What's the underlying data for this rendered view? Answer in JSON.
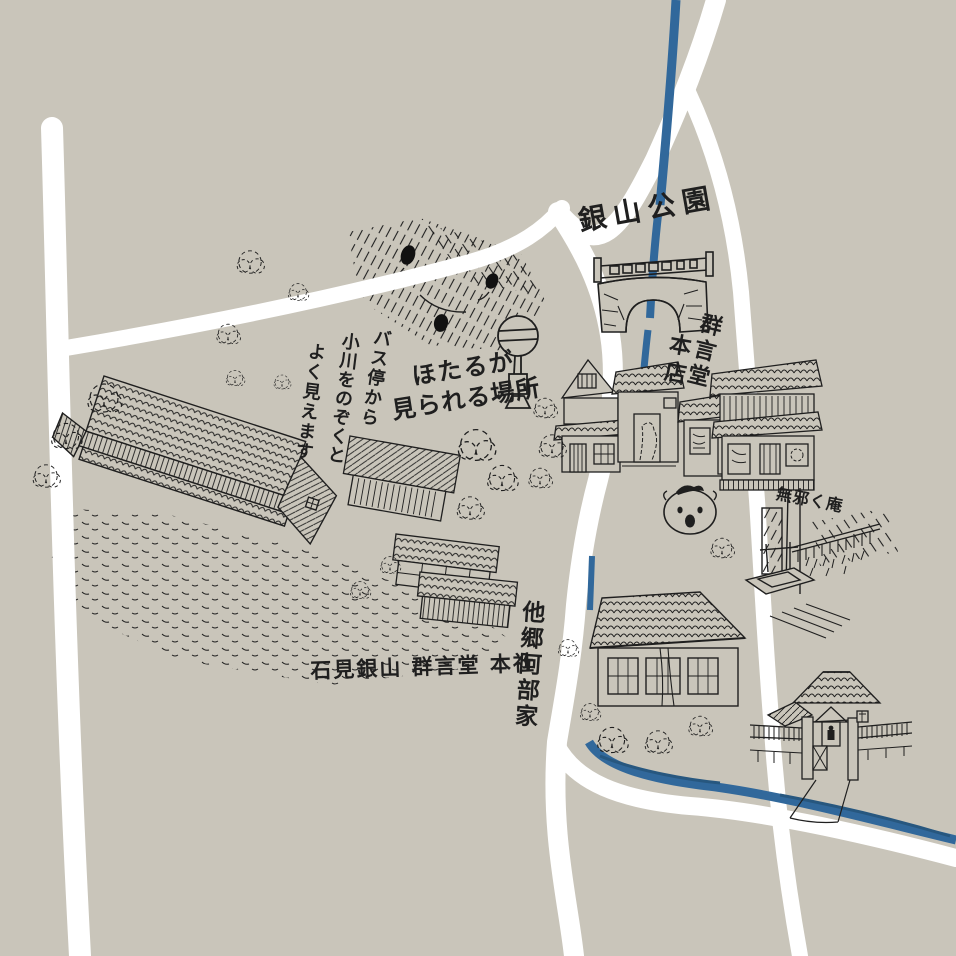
{
  "map": {
    "title": "Hand-drawn illustrated town map",
    "colors": {
      "background": "#c9c5ba",
      "road": "#ffffff",
      "river": "#31689b",
      "ink": "#1f1f1f"
    },
    "labels": {
      "park": "銀山公園",
      "honten_name": "群言堂",
      "honten_branch": "本店",
      "firefly_line1": "ほたるが",
      "firefly_line2": "見られる場所",
      "bus_col1": "バス停から",
      "bus_col2": "小川をのぞくと",
      "bus_col3": "よく見えます",
      "honsha": "石見銀山 群言堂 本社",
      "abeke": "他郷阿部家",
      "mujakuan": "無邪く庵"
    },
    "icons": {
      "bridge": "stone-arch-bridge",
      "bus_stop": "bus-stop-sign",
      "pig_face": "pig-face-signboard",
      "fireflies": "firefly-dots",
      "well": "garden-well",
      "temple_gate": "temple-gate",
      "river": "river-stroke",
      "roads": "road-strokes"
    }
  }
}
